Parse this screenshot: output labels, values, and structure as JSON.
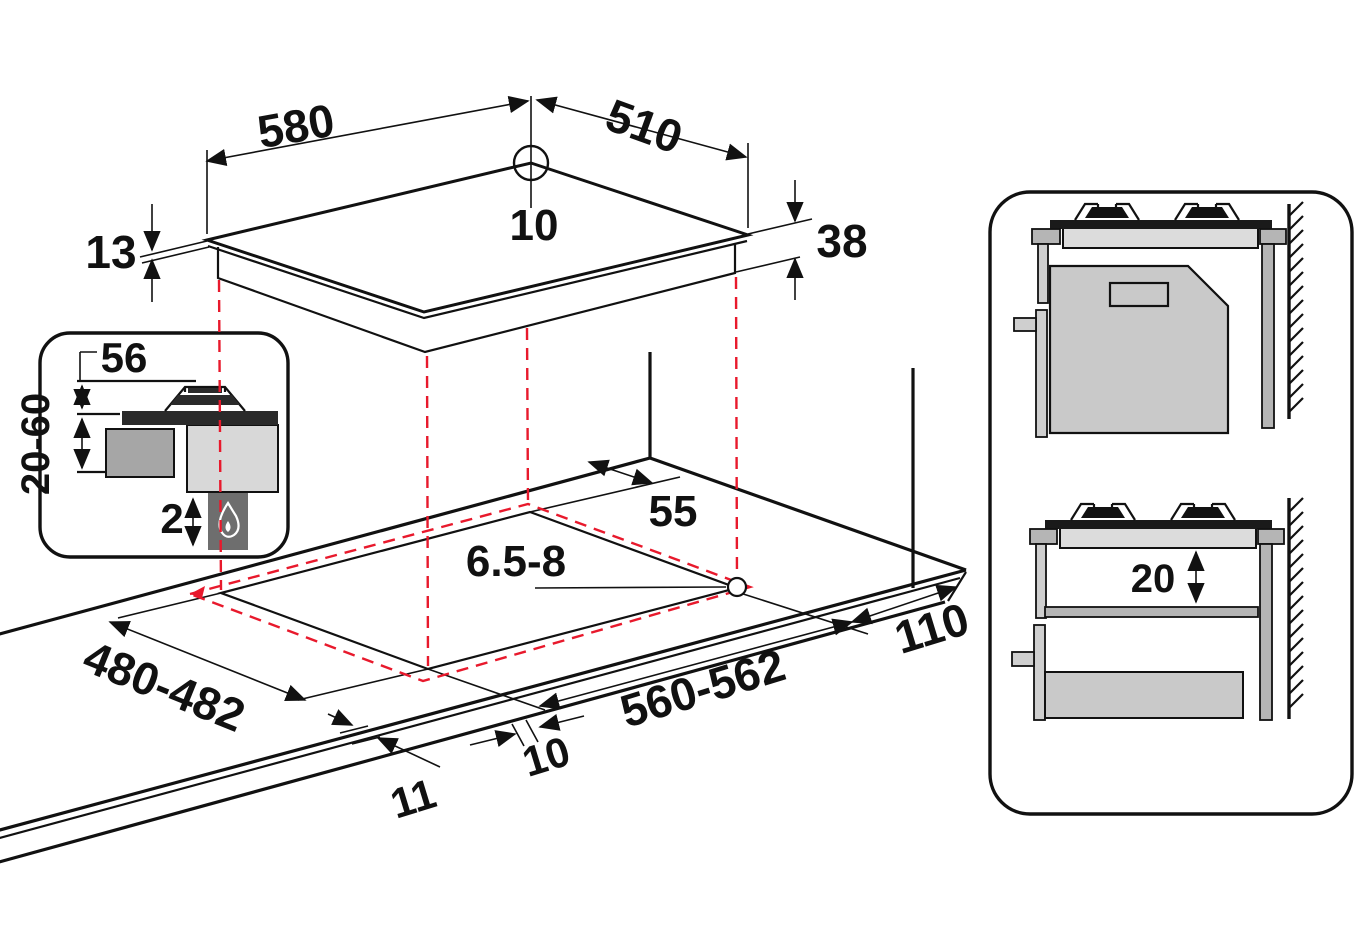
{
  "figure_title": "Gas hob installation drawing (dimensions in mm)",
  "accent_color": "#e8192c",
  "hob_top_view": {
    "width": "580",
    "depth": "510",
    "corner_hole_diameter": "10",
    "rim_thickness": "13",
    "body_height": "38"
  },
  "inset_detail": {
    "grate_height": "56",
    "worktop_thickness_range": "20-60",
    "bottom_clearance": "2",
    "flame_icon": "gas-flame"
  },
  "worktop_cutout": {
    "rear_clearance": "55",
    "fixing_hole_diameter": "6.5-8",
    "cutout_depth": "480-482",
    "cutout_width": "560-562",
    "side_clearance": "110",
    "front_overhang": "10",
    "side_overhang": "11"
  },
  "side_view_panel": {
    "shelf_clearance": "20"
  }
}
